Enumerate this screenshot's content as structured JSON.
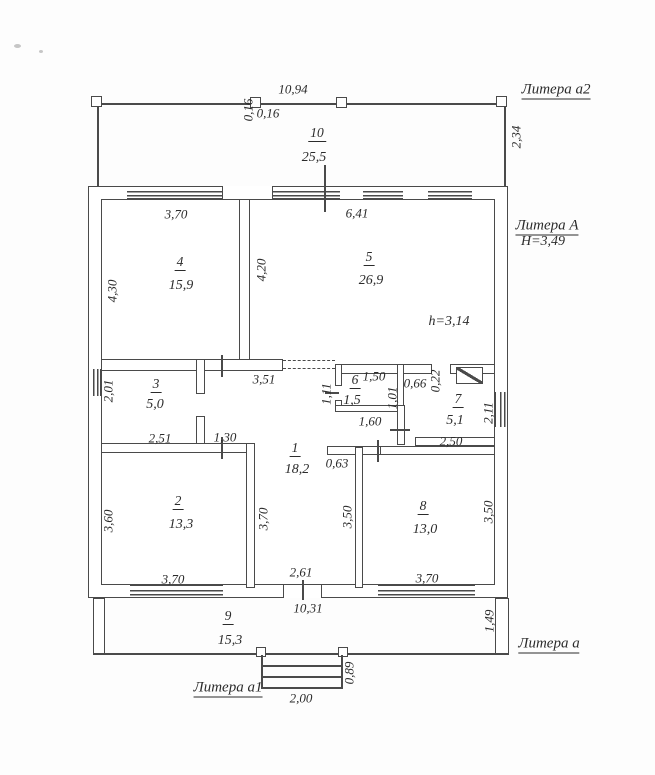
{
  "plan": {
    "building_labels": {
      "litera_a2": "Литера а2",
      "litera_A": "Литера А",
      "litera_A_height": "Н=3,49",
      "interior_height": "h=3,14",
      "litera_a": "Литера а",
      "litera_a1": "Литера а1"
    },
    "rooms": {
      "r1": {
        "number": "1",
        "area": "18,2"
      },
      "r2": {
        "number": "2",
        "area": "13,3"
      },
      "r3": {
        "number": "3",
        "area": "5,0"
      },
      "r4": {
        "number": "4",
        "area": "15,9"
      },
      "r5": {
        "number": "5",
        "area": "26,9"
      },
      "r6": {
        "number": "6",
        "area": "1,5"
      },
      "r7": {
        "number": "7",
        "area": "5,1"
      },
      "r8": {
        "number": "8",
        "area": "13,0"
      },
      "r9": {
        "number": "9",
        "area": "15,3"
      },
      "r10": {
        "number": "10",
        "area": "25,5"
      }
    },
    "dimensions": {
      "total_top": "10,94",
      "post_h": "0,16",
      "post_v": "0,16",
      "veranda_a2_depth": "2,34",
      "r4_width": "3,70",
      "r5_width": "6,41",
      "r4_height": "4,30",
      "r5_height": "4,20",
      "hall_width_top": "3,51",
      "r3_height": "2,01",
      "r3_width": "2,51",
      "door_1_30": "1,30",
      "r6_width_top": "1,50",
      "r6_height_left": "1,11",
      "r6_height_right": "1,01",
      "r6_width_bottom": "1,60",
      "d_0_66": "0,66",
      "d_0_22": "0,22",
      "r7_width": "2,50",
      "r7_height": "2,11",
      "d_0_63": "0,63",
      "r2_height": "3,60",
      "r2_width": "3,70",
      "r2_wall_right": "3,70",
      "r1_height": "3,50",
      "r8_height": "3,50",
      "r8_width": "3,70",
      "hall_width_bottom": "2,61",
      "total_bottom": "10,31",
      "r9_height": "1,49",
      "porch_width": "2,00",
      "porch_depth": "0,89"
    }
  }
}
